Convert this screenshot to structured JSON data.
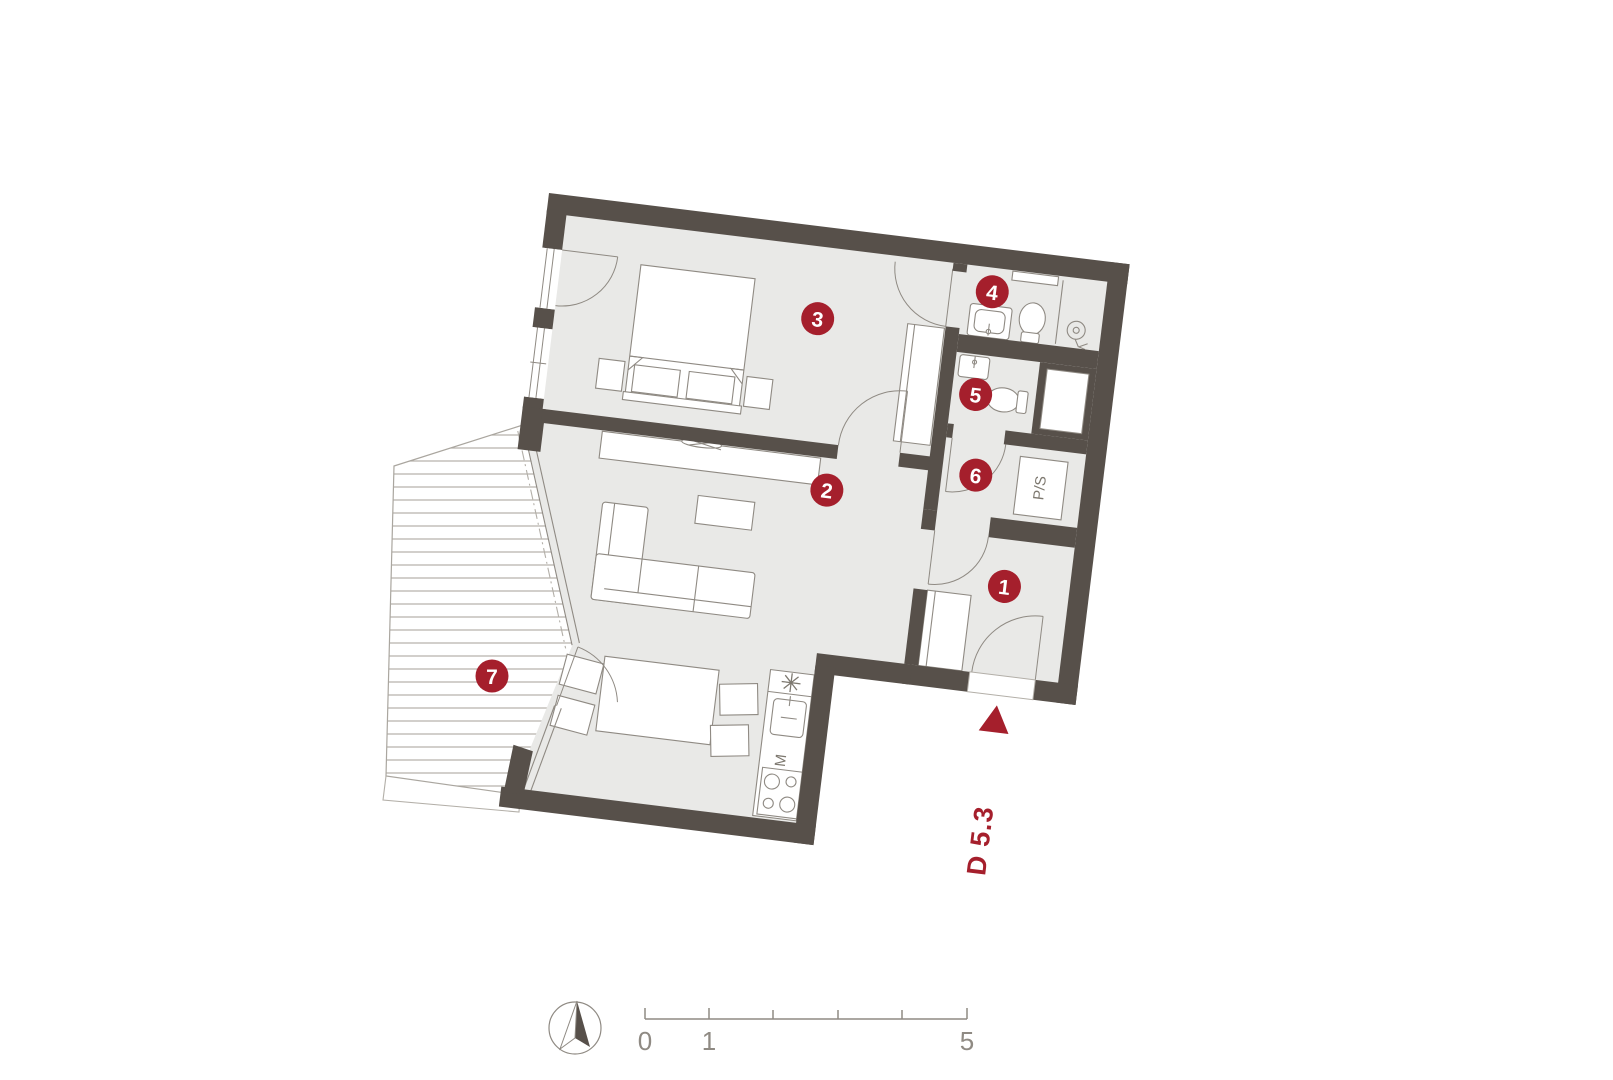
{
  "plan": {
    "title": "apartment-floor-plan",
    "unit_marker": {
      "label": "D 5.3"
    },
    "rooms": {
      "r1": {
        "number": "1"
      },
      "r2": {
        "number": "2"
      },
      "r3": {
        "number": "3"
      },
      "r4": {
        "number": "4"
      },
      "r5": {
        "number": "5"
      },
      "r6": {
        "number": "6"
      },
      "r7": {
        "number": "7"
      }
    },
    "kitchen": {
      "star": "✳",
      "m_label": "M"
    },
    "utility": {
      "ps_label": "P/S"
    },
    "scale_bar": {
      "tick0": "0",
      "tick1": "1",
      "tick5": "5"
    },
    "colors": {
      "wall": "#57504a",
      "floor": "#e9e9e7",
      "accent_red": "#a51f2c",
      "line": "#8f8a83"
    }
  }
}
